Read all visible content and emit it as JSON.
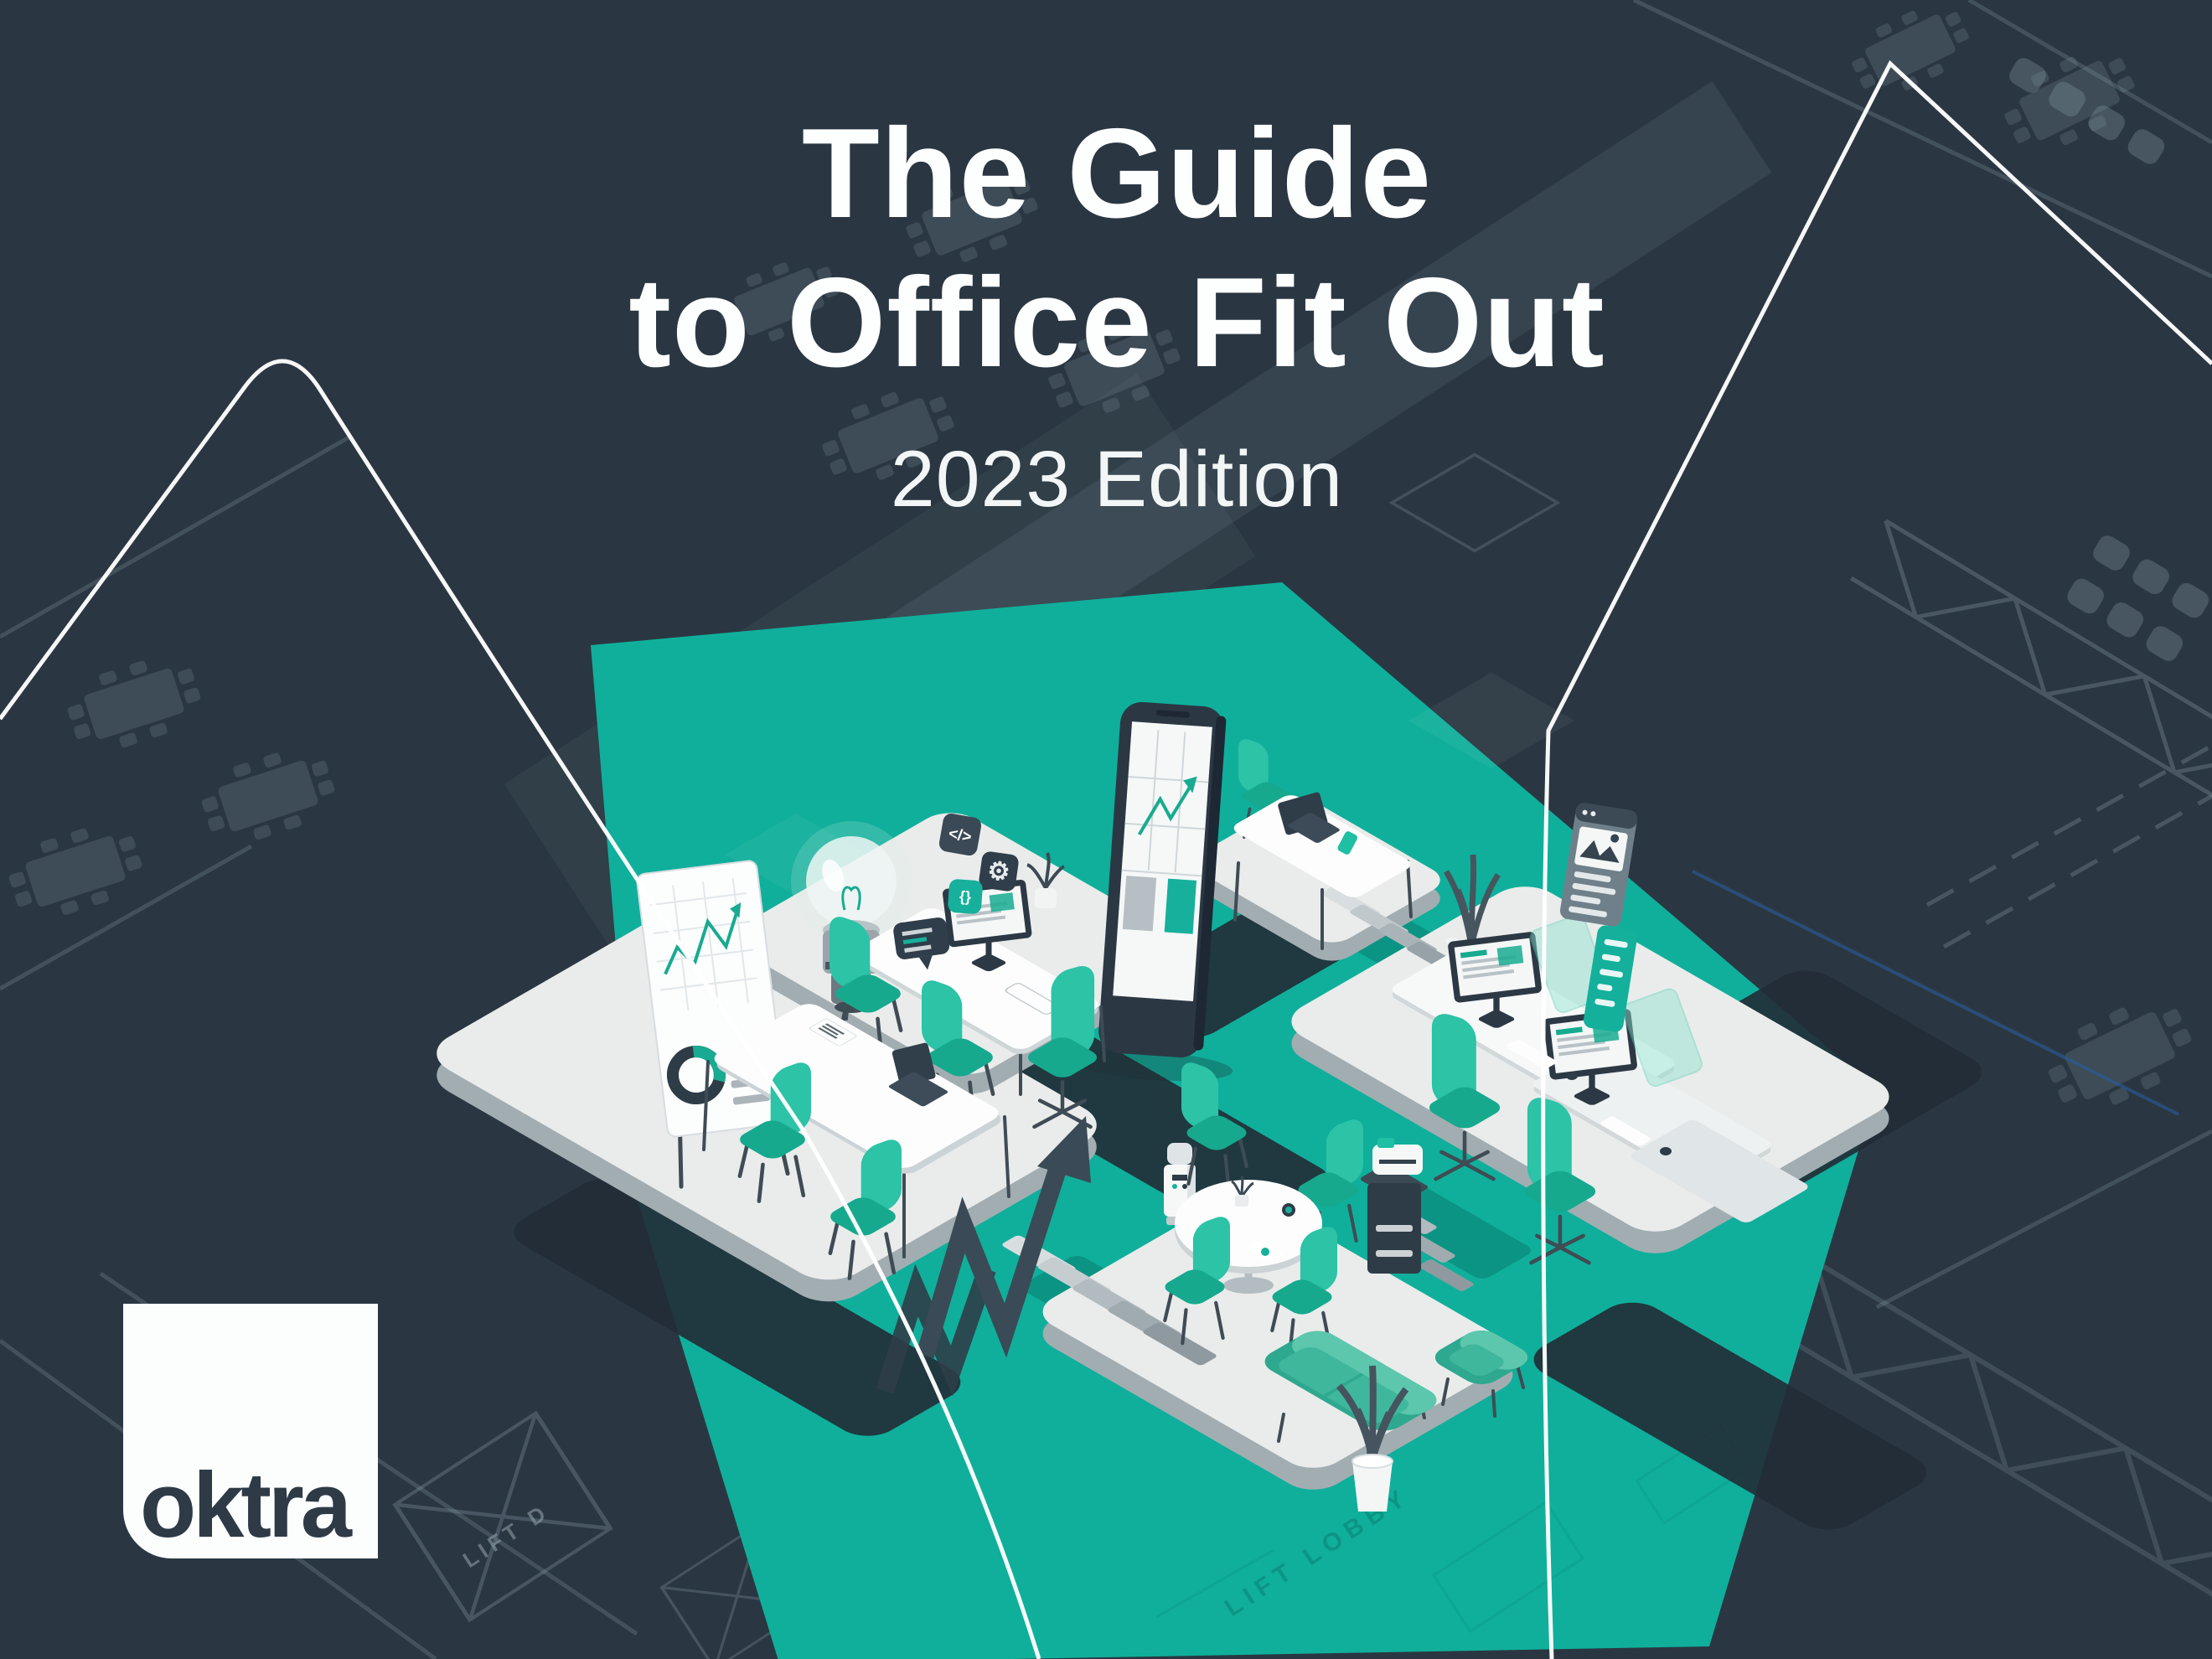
{
  "title": {
    "line1": "The Guide",
    "line2": "to Office Fit Out",
    "edition": "2023 Edition"
  },
  "logo": {
    "text": "oktra"
  },
  "blueprint": {
    "lift_label": "LIFT D",
    "lobby_label": "LIFT LOBBY"
  },
  "icons": {
    "code": "</>",
    "braces": "{}",
    "gear": "⚙"
  },
  "colors": {
    "background": "#2a3742",
    "teal_ground": "#10af9b",
    "teal_dark_walkway": "#0c9181",
    "chair_teal": "#1fbfa4",
    "platform_top": "#e9eceb",
    "platform_side": "#a2adb2",
    "alley_shadow": "#222d37",
    "slate_furniture": "#2f3e4a",
    "white_line": "#ffffff",
    "blueprint_line": "#8da0ab",
    "logo_text": "#2e3b46",
    "title_text": "#fdfefe"
  }
}
